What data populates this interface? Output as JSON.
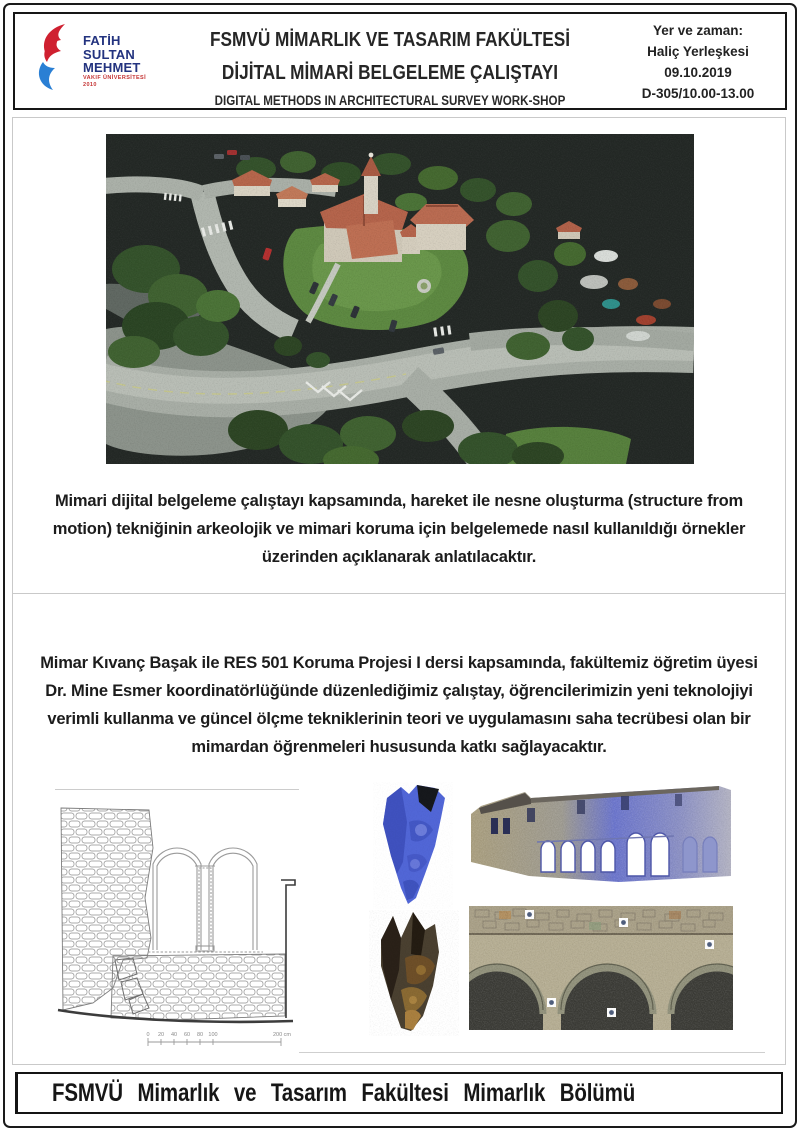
{
  "header": {
    "logo": {
      "name_lines": [
        "FATİH",
        "SULTAN",
        "MEHMET"
      ],
      "subtitle": "VAKIF ÜNİVERSİTESİ",
      "year": "2010"
    },
    "title_tr_line1": "FSMVÜ MİMARLIK VE TASARIM FAKÜLTESİ",
    "title_tr_line2": "DİJİTAL MİMARİ BELGELEME ÇALIŞTAYI",
    "title_en": "DIGITAL METHODS IN ARCHITECTURAL SURVEY WORK-SHOP",
    "info": {
      "label": "Yer ve zaman:",
      "venue": "Haliç Yerleşkesi",
      "date": "09.10.2019",
      "room_time": "D-305/10.00-13.00"
    }
  },
  "section1": {
    "paragraph": "Mimari dijital belgeleme çalıştayı kapsamında, hareket ile nesne oluşturma (structure from motion) tekniğinin arkeolojik ve mimari koruma için belgelemede nasıl kullanıldığı örnekler üzerinden açıklanarak anlatılacaktır."
  },
  "section2": {
    "paragraph": "Mimar Kıvanç Başak ile RES 501 Koruma Projesi I dersi kapsamında, fakültemiz öğretim üyesi  Dr. Mine Esmer koordinatörlüğünde düzenlediğimiz çalıştay, öğrencilerimizin yeni teknolojiyi verimli kullanma ve güncel ölçme tekniklerinin teori ve uygulamasını saha tecrübesi olan bir mimardan öğrenmeleri hususunda katkı sağlayacaktır.",
    "scale_bar": {
      "ticks": [
        "0",
        "20",
        "40",
        "60",
        "80",
        "100"
      ],
      "end_label": "200 cm"
    }
  },
  "images": {
    "main_alt": "aerial photogrammetric point cloud of campus with red-roofed buildings",
    "drawing_alt": "stone wall elevation line drawing with twin arched windows",
    "capital_blue_alt": "blue 3D mesh of carved capital fragment",
    "facade_alt": "laser-scan point cloud of stone facade with arched gallery",
    "capital_textured_alt": "textured 3D model of carved capital fragment",
    "arches_alt": "point cloud of stone arcade"
  },
  "footer": {
    "text": "FSMVÜ Mimarlık ve Tasarım Fakültesi Mimarlık Bölümü"
  },
  "colors": {
    "accent_red": "#cf2030",
    "accent_blue": "#23337f",
    "border_dark": "#161616",
    "border_light": "#c9c9c9",
    "pointcloud_bg": "#232825"
  }
}
